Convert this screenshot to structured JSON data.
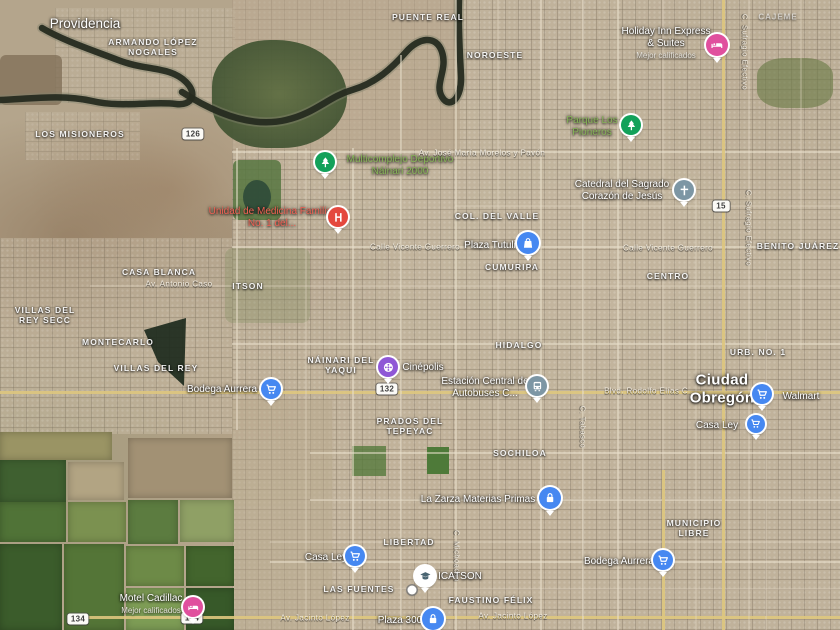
{
  "map": {
    "type": "satellite",
    "city": "Ciudad Obregón",
    "colors": {
      "pin_blue": "#4688f1",
      "pin_pink": "#e0509e",
      "pin_green": "#13a15a",
      "pin_red": "#e4483e",
      "pin_gray": "#7d96a4",
      "pin_purple": "#8f57d6"
    }
  },
  "labels": [
    {
      "text": "Providencia",
      "type": "t-town",
      "x": 85,
      "y": 24
    },
    {
      "text": "ARMANDO LÓPEZ NOGALES",
      "type": "t-hood",
      "x": 153,
      "y": 47,
      "w": 100
    },
    {
      "text": "PUENTE REAL",
      "type": "t-hood",
      "x": 428,
      "y": 17
    },
    {
      "text": "NOROESTE",
      "type": "t-hood",
      "x": 495,
      "y": 55
    },
    {
      "text": "CAJEME",
      "type": "t-hood-dim",
      "x": 778,
      "y": 17
    },
    {
      "text": "Holiday Inn Express & Suites",
      "type": "t-poi",
      "x": 666,
      "y": 43,
      "w": 92,
      "sub": "Mejor calificados",
      "click": true
    },
    {
      "text": "LOS MISIONEROS",
      "type": "t-hood",
      "x": 80,
      "y": 134
    },
    {
      "text": "Parque Los Pioneros",
      "type": "t-poi-green",
      "x": 592,
      "y": 127,
      "w": 72,
      "click": true
    },
    {
      "text": "Multicomplejo Deportivo Náinari 2000",
      "type": "t-poi-green",
      "x": 400,
      "y": 166,
      "w": 124,
      "click": true
    },
    {
      "text": "Av. José María Morelos y Pavón",
      "type": "t-street",
      "x": 482,
      "y": 153
    },
    {
      "text": "Catedral del Sagrado Corazón de Jesús",
      "type": "t-poi",
      "x": 622,
      "y": 191,
      "w": 120,
      "click": true
    },
    {
      "text": "Unidad de Medicina Familiar No. 1 del...",
      "type": "t-poi-red",
      "x": 272,
      "y": 218,
      "w": 135,
      "click": true
    },
    {
      "text": "COL. DEL VALLE",
      "type": "t-hood",
      "x": 497,
      "y": 216
    },
    {
      "text": "Plaza Tutuli",
      "type": "t-poi",
      "x": 490,
      "y": 246,
      "click": true
    },
    {
      "text": "Calle Vicente Guerrero",
      "type": "t-street",
      "x": 415,
      "y": 247
    },
    {
      "text": "Calle Vicente Guerrero",
      "type": "t-street",
      "x": 668,
      "y": 248
    },
    {
      "text": "CUMURIPA",
      "type": "t-hood",
      "x": 512,
      "y": 267
    },
    {
      "text": "CENTRO",
      "type": "t-hood",
      "x": 668,
      "y": 276
    },
    {
      "text": "BENITO JUÁREZ",
      "type": "t-hood",
      "x": 798,
      "y": 246
    },
    {
      "text": "CASA BLANCA",
      "type": "t-hood",
      "x": 159,
      "y": 272
    },
    {
      "text": "Av. Antonio Caso",
      "type": "t-street",
      "x": 179,
      "y": 284
    },
    {
      "text": "ITSON",
      "type": "t-hood",
      "x": 248,
      "y": 286
    },
    {
      "text": "C. Sufragio Efectivo",
      "type": "t-streetv",
      "x": 744,
      "y": 52
    },
    {
      "text": "C. Sufragio Efectivo",
      "type": "t-streetv",
      "x": 748,
      "y": 228
    },
    {
      "text": "VILLAS DEL REY SECC",
      "type": "t-hood",
      "x": 45,
      "y": 315,
      "w": 74
    },
    {
      "text": "MONTECARLO",
      "type": "t-hood",
      "x": 118,
      "y": 342
    },
    {
      "text": "VILLAS DEL REY",
      "type": "t-hood",
      "x": 156,
      "y": 368
    },
    {
      "text": "URB. NO. 1",
      "type": "t-hood",
      "x": 758,
      "y": 352
    },
    {
      "text": "HIDALGO",
      "type": "t-hood",
      "x": 519,
      "y": 345
    },
    {
      "text": "NÁINARI DEL YAQUI",
      "type": "t-hood",
      "x": 341,
      "y": 365,
      "w": 70
    },
    {
      "text": "Cinépolis",
      "type": "t-poi",
      "x": 423,
      "y": 368,
      "click": true
    },
    {
      "text": "Estación Central de Autobuses C...",
      "type": "t-poi",
      "x": 485,
      "y": 388,
      "w": 112,
      "click": true
    },
    {
      "text": "Blvd. Rodolfo Elías C...",
      "type": "t-street",
      "x": 650,
      "y": 391
    },
    {
      "text": "Ciudad Obregón",
      "type": "t-city",
      "x": 722,
      "y": 389,
      "w": 80
    },
    {
      "text": "Walmart",
      "type": "t-poi",
      "x": 801,
      "y": 397,
      "click": true
    },
    {
      "text": "Bodega Aurrera",
      "type": "t-poi",
      "x": 222,
      "y": 390,
      "click": true
    },
    {
      "text": "PRADOS DEL TEPEYAC",
      "type": "t-hood",
      "x": 410,
      "y": 426,
      "w": 76
    },
    {
      "text": "Casa Ley",
      "type": "t-poi",
      "x": 717,
      "y": 426,
      "click": true
    },
    {
      "text": "SOCHILOA",
      "type": "t-hood",
      "x": 520,
      "y": 453
    },
    {
      "text": "C. Tabasco",
      "type": "t-streetv",
      "x": 582,
      "y": 427
    },
    {
      "text": "C. Michoacán",
      "type": "t-streetv",
      "x": 456,
      "y": 556
    },
    {
      "text": "La Zarza Materias Primas",
      "type": "t-poi",
      "x": 478,
      "y": 500,
      "click": true
    },
    {
      "text": "MUNICIPIO LIBRE",
      "type": "t-hood",
      "x": 694,
      "y": 528,
      "w": 72
    },
    {
      "text": "LIBERTAD",
      "type": "t-hood",
      "x": 409,
      "y": 542
    },
    {
      "text": "Casa Ley",
      "type": "t-poi",
      "x": 326,
      "y": 558,
      "click": true
    },
    {
      "text": "Bodega Aurrera",
      "type": "t-poi",
      "x": 619,
      "y": 562,
      "click": true
    },
    {
      "text": "ICATSON",
      "type": "t-poi",
      "x": 460,
      "y": 577,
      "click": true
    },
    {
      "text": "LAS FUENTES",
      "type": "t-hood",
      "x": 359,
      "y": 589
    },
    {
      "text": "FAUSTINO FÉLIX",
      "type": "t-hood",
      "x": 491,
      "y": 600
    },
    {
      "text": "Motel Cadillac",
      "type": "t-poi",
      "x": 151,
      "y": 604,
      "sub": "Mejor calificados",
      "click": true
    },
    {
      "text": "Av. Jacinto López",
      "type": "t-street",
      "x": 315,
      "y": 618
    },
    {
      "text": "Av. Jacinto López",
      "type": "t-street",
      "x": 513,
      "y": 616
    },
    {
      "text": "Plaza 300",
      "type": "t-poi",
      "x": 400,
      "y": 621,
      "click": true
    }
  ],
  "pins": [
    {
      "name": "holiday-inn",
      "icon": "bed",
      "color": "#e0509e",
      "x": 717,
      "y": 45,
      "s": 22
    },
    {
      "name": "parque-los-pioneros",
      "icon": "tree",
      "color": "#13a15a",
      "x": 631,
      "y": 125,
      "s": 20
    },
    {
      "name": "multicomplejo-deportivo",
      "icon": "tree",
      "color": "#13a15a",
      "x": 325,
      "y": 162,
      "s": 20
    },
    {
      "name": "catedral-sagrado-corazon",
      "icon": "cross",
      "color": "#7d96a4",
      "x": 684,
      "y": 190,
      "s": 20
    },
    {
      "name": "unidad-medicina-familiar",
      "icon": "hospital",
      "color": "#e4483e",
      "x": 338,
      "y": 217,
      "s": 20
    },
    {
      "name": "plaza-tutuli",
      "icon": "bag",
      "color": "#4688f1",
      "x": 528,
      "y": 243,
      "s": 22
    },
    {
      "name": "cinepolis",
      "icon": "reel",
      "color": "#8f57d6",
      "x": 388,
      "y": 367,
      "s": 20
    },
    {
      "name": "estacion-central-autobuses",
      "icon": "bus",
      "color": "#7d96a4",
      "x": 537,
      "y": 386,
      "s": 20
    },
    {
      "name": "walmart",
      "icon": "cart",
      "color": "#4688f1",
      "x": 762,
      "y": 394,
      "s": 20
    },
    {
      "name": "bodega-aurrera",
      "icon": "cart",
      "color": "#4688f1",
      "x": 271,
      "y": 389,
      "s": 20
    },
    {
      "name": "bodega-aurrera-sur",
      "icon": "cart",
      "color": "#4688f1",
      "x": 663,
      "y": 560,
      "s": 20
    },
    {
      "name": "casa-ley",
      "icon": "cart",
      "color": "#4688f1",
      "x": 355,
      "y": 556,
      "s": 20
    },
    {
      "name": "casa-ley-norte",
      "icon": "cart",
      "color": "#4688f1",
      "x": 756,
      "y": 424,
      "s": 18
    },
    {
      "name": "la-zarza",
      "icon": "lock",
      "color": "#4688f1",
      "x": 550,
      "y": 498,
      "s": 22
    },
    {
      "name": "plaza-300",
      "icon": "lock",
      "color": "#4688f1",
      "x": 433,
      "y": 619,
      "s": 22
    },
    {
      "name": "icatson",
      "icon": "grad",
      "color": "#ffffff",
      "ic": "#4a6572",
      "x": 425,
      "y": 576,
      "s": 20
    },
    {
      "name": "motel-cadillac",
      "icon": "bed",
      "color": "#e0509e",
      "x": 193,
      "y": 607,
      "s": 20
    },
    {
      "name": "small-poi",
      "icon": "dot",
      "color": "#ffffff",
      "x": 412,
      "y": 590,
      "s": 9
    }
  ],
  "shields": [
    {
      "text": "126",
      "x": 193,
      "y": 134
    },
    {
      "text": "15",
      "x": 721,
      "y": 206
    },
    {
      "text": "132",
      "x": 387,
      "y": 389
    },
    {
      "text": "134",
      "x": 192,
      "y": 618
    },
    {
      "text": "134",
      "x": 78,
      "y": 619
    }
  ]
}
